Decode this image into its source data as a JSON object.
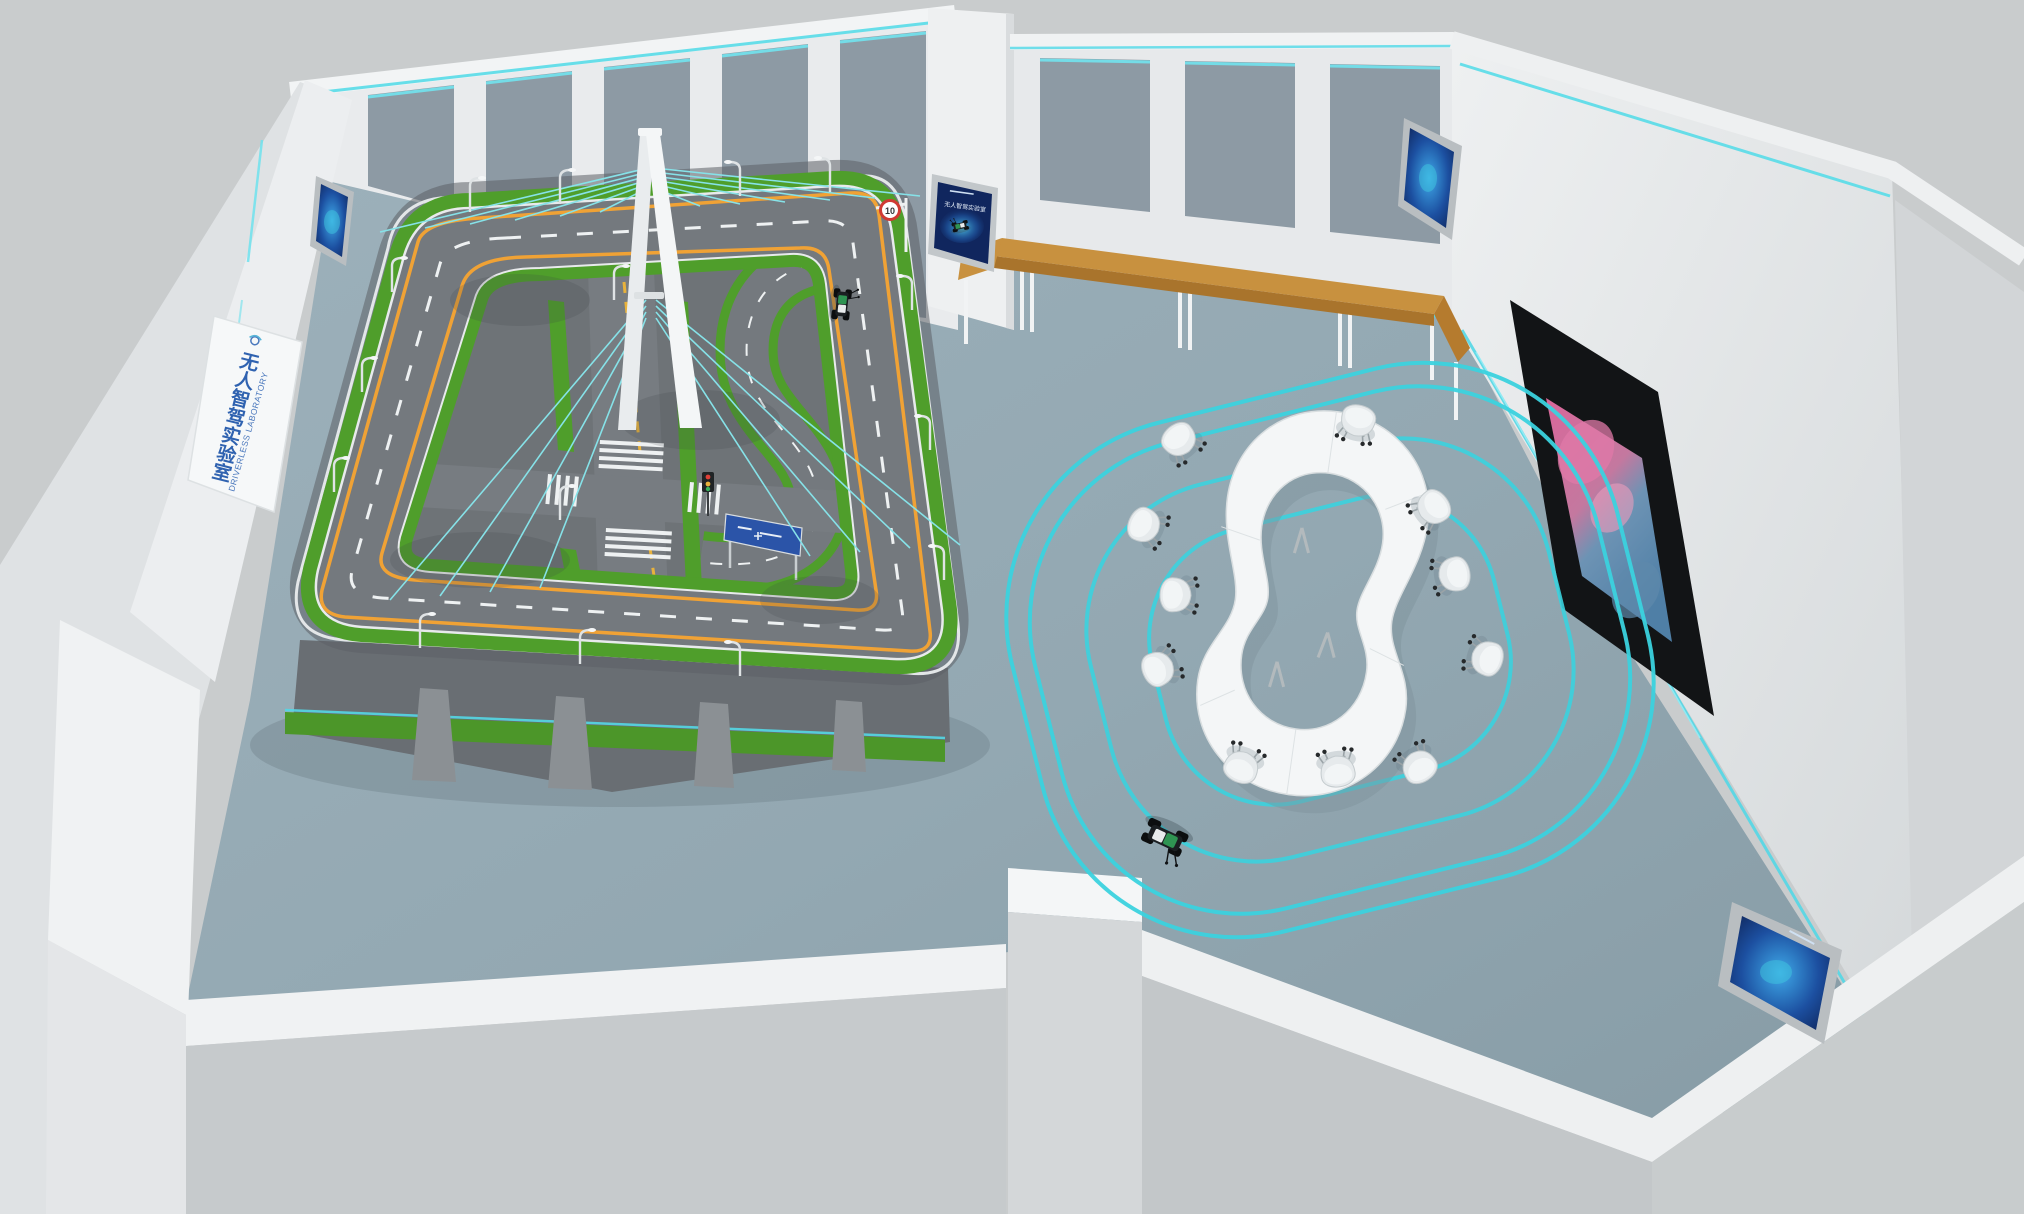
{
  "scene": {
    "description": "Isometric 3D render of a driverless-driving laboratory room",
    "left_wall_sign": {
      "cn": "无人智驾实验室",
      "en": "DRIVERLESS LABORATORY"
    },
    "poster": {
      "title": "无人智驾实验室"
    },
    "track_model": {
      "speed_limit_sign": "10",
      "features": [
        "elevated loop road",
        "cable-stayed bridge",
        "crosswalk intersection",
        "street lamps",
        "guardrails",
        "blue direction sign",
        "traffic light"
      ],
      "robot_cars": 1
    },
    "meeting_area": {
      "table_shape": "peanut ring",
      "chairs": 11,
      "floor_guide_loops": 4,
      "floor_robot_cars": 1
    },
    "displays": {
      "small_wall_screens": 3,
      "large_wall_screen_content": "pink and blue abstract artwork",
      "bench": "wooden top with white legs"
    },
    "colors": {
      "accent_cyan": "#45d7e3",
      "floor": "#93a8b2",
      "wall": "#e9ebed",
      "wall_panel": "#8d9aa4",
      "grass": "#55a32f",
      "road": "#75797e",
      "road_line_orange": "#f0a235",
      "wood": "#c8913f",
      "table": "#f3f5f6",
      "poster_blue": "#10265e",
      "sign_text_blue": "#3a6ab8"
    }
  }
}
